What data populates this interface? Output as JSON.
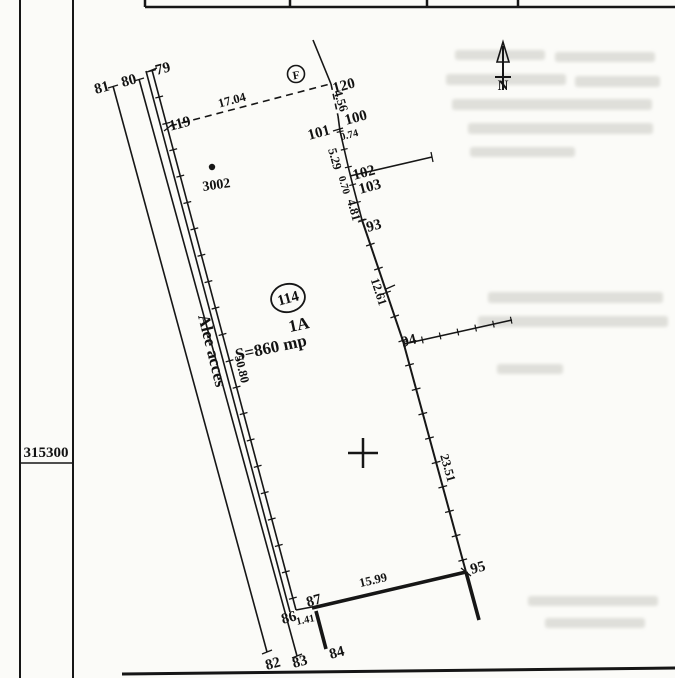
{
  "frame": {
    "grid_northing": "315300"
  },
  "plan": {
    "points": {
      "p79": "79",
      "p80": "80",
      "p81": "81",
      "p82": "82",
      "p83": "83",
      "p84": "84",
      "p86": "86",
      "p87": "87",
      "p93": "93",
      "p94": "94",
      "p95": "95",
      "p100": "100",
      "p101": "101",
      "p102": "102",
      "p103": "103",
      "p119": "119",
      "p120": "120"
    },
    "distances": {
      "d17_04": "17.04",
      "d4_56": "4.56",
      "d0_74": "0.74",
      "d5_29": "5.29",
      "d0_70": "0.70",
      "d4_81": "4.81",
      "d12_61": "12.61",
      "d23_51": "23.51",
      "d15_99": "15.99",
      "d50_80": "50.80",
      "d1_41": "1.41"
    },
    "parcel": {
      "circled_number": "114",
      "lot": "1A",
      "area": "S=860 mp"
    },
    "road_name": "Alee acces",
    "landmark": "3002",
    "circled_letter": "F",
    "north_letter": "N"
  }
}
